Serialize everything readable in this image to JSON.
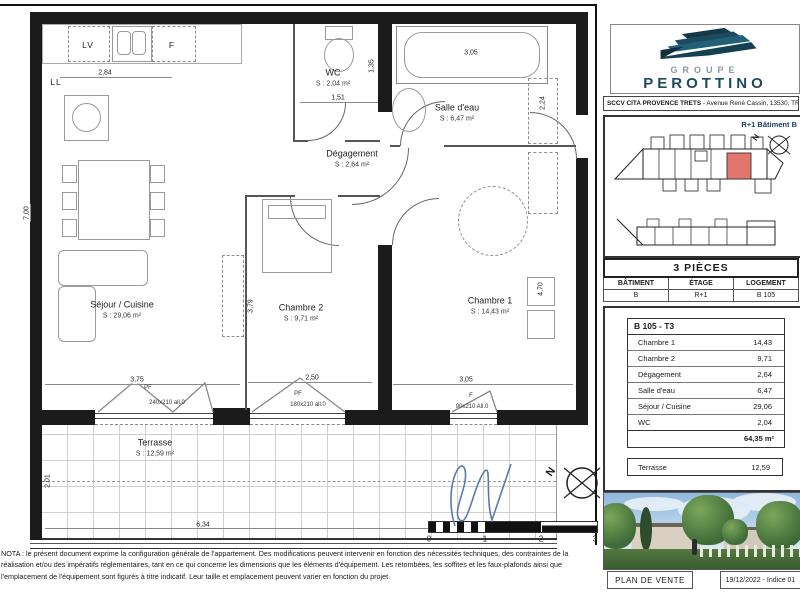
{
  "plan": {
    "north": "N",
    "rooms": {
      "wc": {
        "name": "WC",
        "area": "S : 2,04 m²"
      },
      "salle_eau": {
        "name": "Salle d'eau",
        "area": "S : 6,47 m²"
      },
      "degagement": {
        "name": "Dégagement",
        "area": "S : 2,64 m²"
      },
      "sejour": {
        "name": "Séjour / Cuisine",
        "area": "S : 29,06 m²"
      },
      "chambre2": {
        "name": "Chambre 2",
        "area": "S : 9,71 m²"
      },
      "chambre1": {
        "name": "Chambre 1",
        "area": "S : 14,43 m²"
      },
      "terrasse": {
        "name": "Terrasse",
        "area": "S : 12,59 m²"
      }
    },
    "dims": {
      "kitchen_w": "2,84",
      "sejour_h": "7,00",
      "wc_w": "1,51",
      "wc_h": "1,35",
      "bath_w": "3,05",
      "closet_h": "2,24",
      "ch2_h": "3,79",
      "ch1_h": "4,70",
      "sejour_w": "3,75",
      "ch2_w": "2,50",
      "ch1_w": "3,05",
      "terrasse_h": "2,01",
      "terrasse_w": "6,34"
    },
    "windows": {
      "pf240": {
        "tag": "PF",
        "size": "240x210 all.0"
      },
      "pf180": {
        "tag": "PF",
        "size": "180x210 all.0"
      },
      "f90": {
        "tag": "F",
        "size": "90x210 All.0"
      }
    },
    "labels": {
      "lv": "LV",
      "f": "F",
      "ll": "LL"
    },
    "scale": [
      "0",
      "1",
      "2",
      "3"
    ]
  },
  "sidebar": {
    "logo": {
      "group": "GROUPE",
      "name": "PEROTTINO"
    },
    "address": {
      "bold": "SCCV CITA PROVENCE TRETS",
      "rest": " - Avenue René Cassin, 13530, TRETS"
    },
    "keyplan": {
      "label": "R+1 Bâtiment B",
      "north": "N"
    },
    "pieces": {
      "header": "3 PIÈCES",
      "cols": [
        "BÂTIMENT",
        "ÉTAGE",
        "LOGEMENT"
      ],
      "values": [
        "B",
        "R+1",
        "B 105"
      ]
    },
    "unit": {
      "header": "B 105 - T3",
      "rows": [
        {
          "label": "Chambre 1",
          "value": "14,43"
        },
        {
          "label": "Chambre 2",
          "value": "9,71"
        },
        {
          "label": "Dégagement",
          "value": "2,64"
        },
        {
          "label": "Salle d'eau",
          "value": "6,47"
        },
        {
          "label": "Séjour / Cuisine",
          "value": "29,06"
        },
        {
          "label": "WC",
          "value": "2,04"
        }
      ],
      "total": "64,35 m²",
      "terrace": {
        "label": "Terrasse",
        "value": "12,59"
      }
    },
    "footer": {
      "left": "PLAN DE VENTE",
      "right": "19/12/2022 - Indice 01"
    }
  },
  "nota": "NOTA : le présent document exprime la configuration générale de l'appartement. Des modifications peuvent intervenir en fonction des nécessités techniques, des contraintes de la réalisation et/ou des impératifs réglementaires, tant en ce qui concerne les dimensions que les éléments d'équipement. Les retombées, les soffites et les faux-plafonds ainsi que l'emplacement de l'équipement sont figurés à titre indicatif. Leur taille et emplacement peuvent varier en fonction du projet.",
  "colors": {
    "brand_teal": "#1d4b5e",
    "unit_highlight": "#e2766e"
  }
}
